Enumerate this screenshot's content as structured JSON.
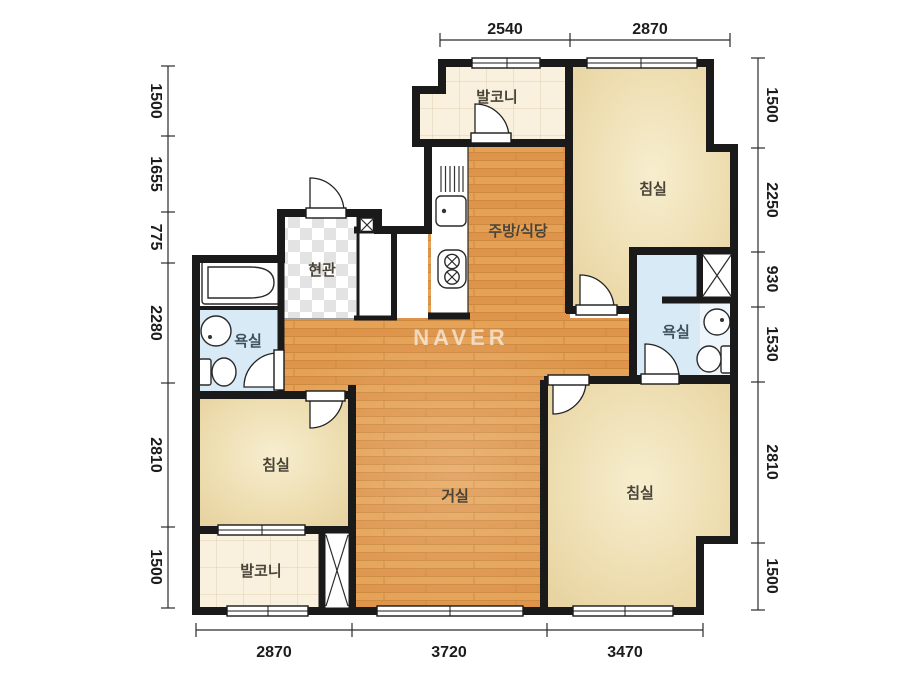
{
  "title": "apartment-floor-plan",
  "watermark": {
    "text": "NAVER"
  },
  "rooms": [
    {
      "id": "balcony-top",
      "label": "발코니",
      "cx": 497,
      "cy": 97
    },
    {
      "id": "bedroom-top-right",
      "label": "침실",
      "cx": 653,
      "cy": 189
    },
    {
      "id": "kitchen-dining",
      "label": "주방/식당",
      "cx": 518,
      "cy": 231
    },
    {
      "id": "entrance",
      "label": "현관",
      "cx": 322,
      "cy": 270
    },
    {
      "id": "bathroom-left",
      "label": "욕실",
      "cx": 248,
      "cy": 341
    },
    {
      "id": "bathroom-right",
      "label": "욕실",
      "cx": 676,
      "cy": 332
    },
    {
      "id": "bedroom-left",
      "label": "침실",
      "cx": 276,
      "cy": 465
    },
    {
      "id": "living-room",
      "label": "거실",
      "cx": 455,
      "cy": 496
    },
    {
      "id": "bedroom-bottom-right",
      "label": "침실",
      "cx": 640,
      "cy": 493
    },
    {
      "id": "balcony-bottom",
      "label": "발코니",
      "cx": 261,
      "cy": 571
    }
  ],
  "dimensions": {
    "top": [
      {
        "value": "2540"
      },
      {
        "value": "2870"
      }
    ],
    "left": [
      {
        "value": "1500"
      },
      {
        "value": "1655"
      },
      {
        "value": "775"
      },
      {
        "value": "2280"
      },
      {
        "value": "2810"
      },
      {
        "value": "1500"
      }
    ],
    "right": [
      {
        "value": "1500"
      },
      {
        "value": "2250"
      },
      {
        "value": "930"
      },
      {
        "value": "1530"
      },
      {
        "value": "2810"
      },
      {
        "value": "1500"
      }
    ],
    "bottom": [
      {
        "value": "2870"
      },
      {
        "value": "3720"
      },
      {
        "value": "3470"
      }
    ]
  },
  "icons": {
    "door-swing": "quarter-circle-arc",
    "window": "double-line-bar",
    "duct-shaft": "x-box",
    "bathtub": "rounded-tub",
    "toilet": "tank-and-bowl",
    "round-sink": "circle-with-dot",
    "kitchen-sink": "rounded-square-dot",
    "stove": "two-crossed-burners",
    "dish-rack": "vertical-lines"
  },
  "colors": {
    "wall": "#1a1a1a",
    "wood_floor": "#e29c50",
    "bedroom_cream": "#ead9ab",
    "balcony_tile": "#f9f0de",
    "bathroom_blue": "#d8eaf5",
    "entrance_checker": "#e3e3e3",
    "dimension_text": "#1c1c1c",
    "room_label_text": "#4a4438",
    "watermark_text": "rgba(255,255,255,0.62)"
  }
}
